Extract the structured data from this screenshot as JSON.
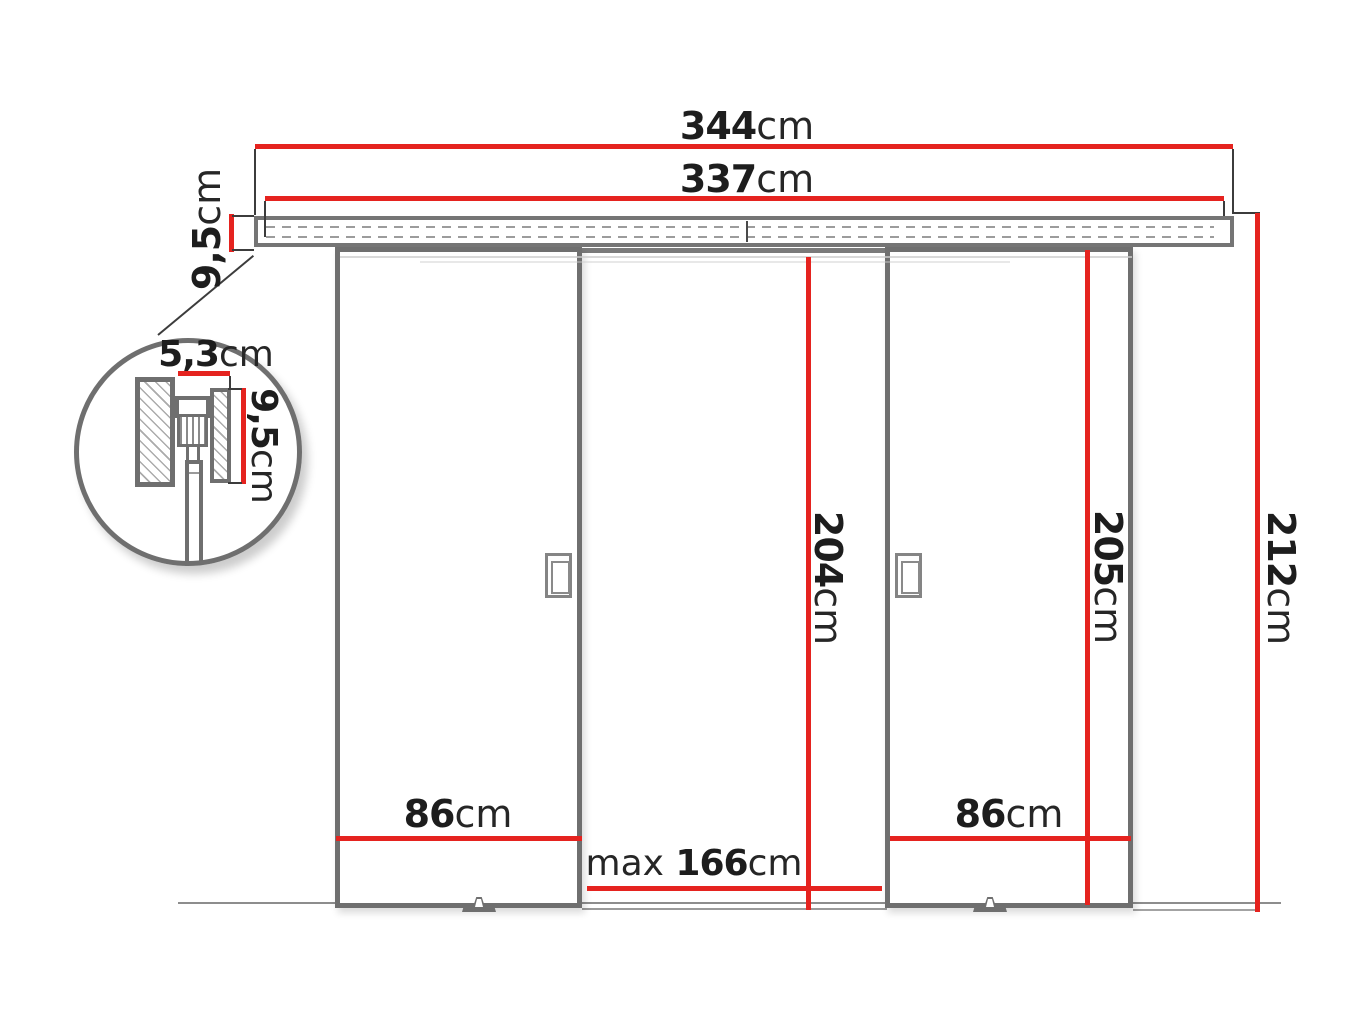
{
  "dimensions": {
    "overall_width": {
      "value": "344",
      "unit": "cm"
    },
    "rail_length": {
      "value": "337",
      "unit": "cm"
    },
    "rail_height": {
      "value": "9,5",
      "unit": "cm"
    },
    "detail_width": {
      "value": "5,3",
      "unit": "cm"
    },
    "detail_height": {
      "value": "9,5",
      "unit": "cm"
    },
    "passage_height": {
      "value": "204",
      "unit": "cm"
    },
    "door_height": {
      "value": "205",
      "unit": "cm"
    },
    "total_height": {
      "value": "212",
      "unit": "cm"
    },
    "left_door_width": {
      "value": "86",
      "unit": "cm"
    },
    "right_door_width": {
      "value": "86",
      "unit": "cm"
    },
    "max_opening_width": {
      "prefix": "max ",
      "value": "166",
      "unit": "cm"
    }
  },
  "colors": {
    "dimension_red": "#e5231f",
    "outline_gray": "#6f6f6f",
    "text_dark": "#1d1d1d"
  }
}
